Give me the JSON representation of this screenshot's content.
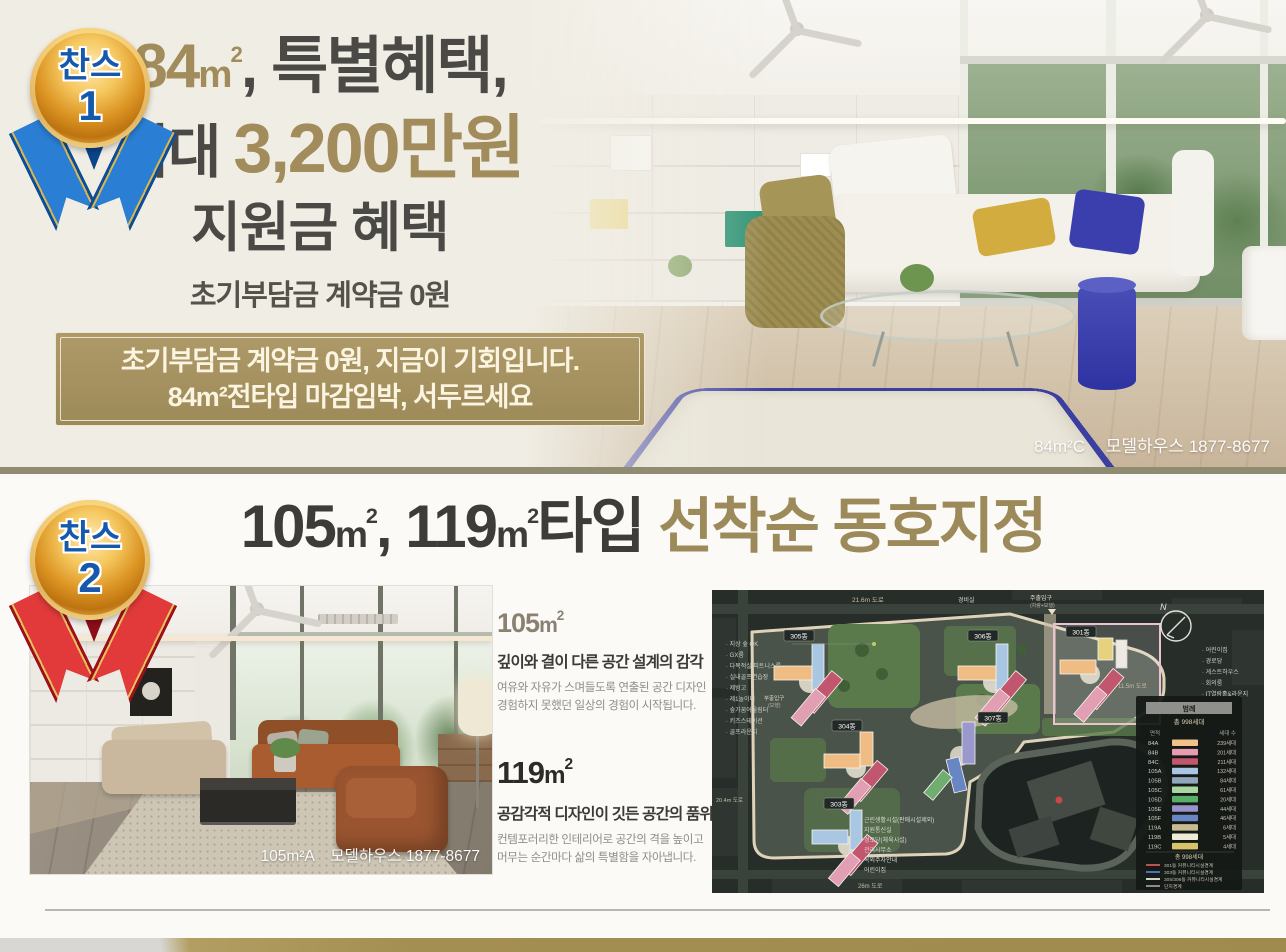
{
  "colors": {
    "page_bg": "#f0ede4",
    "section2_bg": "#fbfaf6",
    "divider": "#8f8c72",
    "gold_text": "#a28c5c",
    "banner_bg": "#a6925f",
    "ribbon1": "#1a6ec4",
    "ribbon2": "#d32f2f",
    "footer_gold": "#a48f52"
  },
  "section1": {
    "badge": {
      "label": "찬스",
      "number": "1"
    },
    "headline": {
      "l1_num": "84",
      "l1_unit": "m",
      "l1_sup": "2",
      "l1_rest": ", 특별혜택,",
      "l2_pre": "최대 ",
      "l2_strong": "3,200만원",
      "l3": "지원금 혜택",
      "l4": "초기부담금 계약금 0원"
    },
    "banner": {
      "line1": "초기부담금 계약금 0원, 지금이 기회입니다.",
      "line2": "84m²전타입 마감임박, 서두르세요"
    },
    "photo": {
      "caption_type": "84m²C",
      "caption_rest": "모델하우스 1877-8677"
    }
  },
  "section2": {
    "badge": {
      "label": "찬스",
      "number": "2"
    },
    "title": {
      "p1n": "105",
      "p1u": "m",
      "p1s": "2",
      "comma": ", ",
      "p2n": "119",
      "p2u": "m",
      "p2s": "2",
      "p3": "타입 ",
      "gold": "선착순 동호지정"
    },
    "type105": {
      "num": "105",
      "unit": "m",
      "sup": "2",
      "headline": "깊이와 결이 다른 공간 설계의 감각",
      "body1": "여유와 자유가 스며들도록 연출된 공간 디자인",
      "body2": "경험하지 못했던 일상의 경험이 시작됩니다."
    },
    "type119": {
      "num": "119",
      "unit": "m",
      "sup": "2",
      "headline": "공감각적 디자인이 깃든 공간의 품위",
      "body1": "컨템포러리한 인테리어로 공간의 격을 높이고",
      "body2": "머무는 순간마다 삶의 특별함을 자아냅니다."
    },
    "photo": {
      "caption_type": "105m²A",
      "caption_rest": "모델하우스 1877-8677"
    }
  },
  "siteplan": {
    "compass_label": "N",
    "buildings": [
      {
        "label": "305동"
      },
      {
        "label": "306동"
      },
      {
        "label": "301동"
      },
      {
        "label": "304동"
      },
      {
        "label": "307동"
      },
      {
        "label": "303동"
      }
    ],
    "road_labels": {
      "top": "21.6m 도로",
      "security": "경비실",
      "gate_main": "주출입구",
      "gate_main_sub": "(차량+보행)",
      "right": "11.5m 도로",
      "bottom": "26m 도로",
      "left": "20.4m 도로",
      "gate_side": "부출입구",
      "gate_side_sub": "(보행)"
    },
    "left_facilities": [
      "· 지상 숲 OK",
      "· GX룸",
      "· 다목적실/피트니스룸",
      "· 실내골프연습장",
      "· 제빙고",
      "· 제1놀이터",
      "· 숲가꿈어울림터",
      "· 키즈스테이션",
      "· 골프라운지"
    ],
    "right_facilities": [
      "· 어린이집",
      "· 경로당",
      "· 게스트하우스",
      "· 회의룸",
      "· IT열람홀&라운지",
      "· 작은도서관"
    ],
    "bottom_facilities": [
      "근린생활시설(판매시설제외)",
      "지원통신실",
      "경로당(체육시설)",
      "관리사무소",
      "옥외주차안내",
      "어린이집"
    ],
    "legend": {
      "title": "범례",
      "subtitle": "총 998세대",
      "col_area": "면적",
      "col_count": "세대 수",
      "rows": [
        {
          "label": "84A",
          "color": "#f2c08a",
          "count": "239세대"
        },
        {
          "label": "84B",
          "color": "#e89cb0",
          "count": "201세대"
        },
        {
          "label": "84C",
          "color": "#c2566e",
          "count": "211세대"
        },
        {
          "label": "105A",
          "color": "#a9c6e2",
          "count": "132세대"
        },
        {
          "label": "105B",
          "color": "#8fa6bc",
          "count": "84세대"
        },
        {
          "label": "105C",
          "color": "#a8d6a0",
          "count": "61세대"
        },
        {
          "label": "105D",
          "color": "#57b06a",
          "count": "20세대"
        },
        {
          "label": "105E",
          "color": "#9694c8",
          "count": "44세대"
        },
        {
          "label": "105F",
          "color": "#6886c4",
          "count": "46세대"
        },
        {
          "label": "119A",
          "color": "#c8bb92",
          "count": "6세대"
        },
        {
          "label": "119B",
          "color": "#f0ead8",
          "count": "5세대"
        },
        {
          "label": "119C",
          "color": "#d8c468",
          "count": "4세대"
        }
      ],
      "total": "총 998세대",
      "boundary_lines": [
        {
          "color": "#d05858",
          "label": "301동 커뮤니티시설경계"
        },
        {
          "color": "#5878c8",
          "label": "303동 커뮤니티시설경계"
        },
        {
          "color": "#e8e8e4",
          "label": "305/306동 커뮤니티시설경계"
        },
        {
          "color": "#9a9a96",
          "label": "단지경계"
        }
      ]
    }
  }
}
